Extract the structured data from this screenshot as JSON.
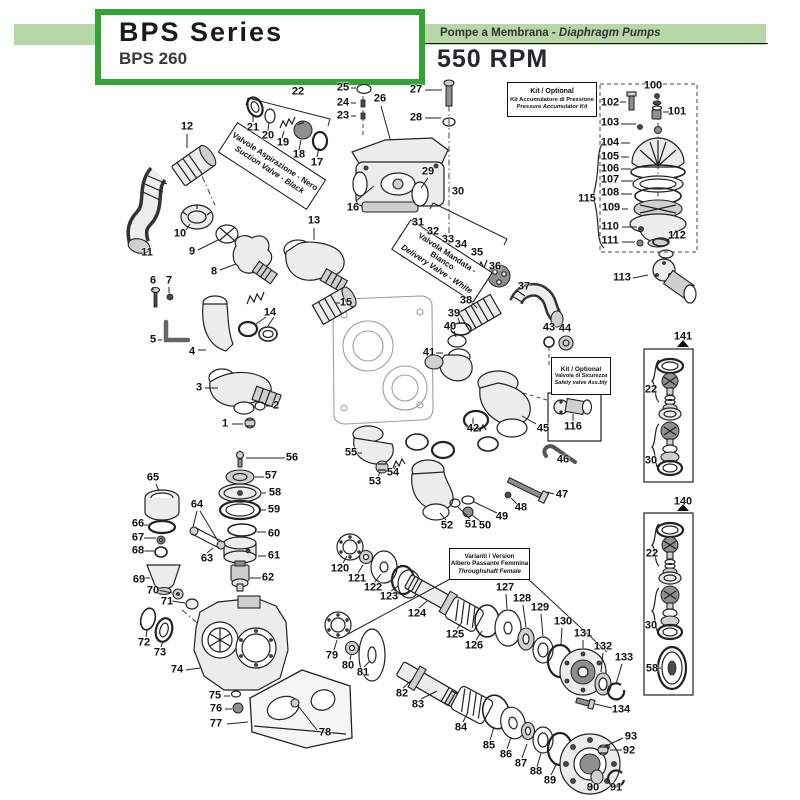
{
  "header": {
    "series_title": "BPS Series",
    "model": "BPS 260",
    "category_it": "Pompe a Membrana",
    "category_sep": " - ",
    "category_en": "Diaphragm Pumps",
    "rpm": "550 RPM",
    "accent_green": "#33A433",
    "band_green": "#B7D8A6"
  },
  "labels": {
    "suction_l1": "Valvole Aspirazione - Nero",
    "suction_l2": "Suction Valve - Black",
    "delivery_l1": "Valvola Mandata - Bianco",
    "delivery_l2": "Delivery Valve - White",
    "acc_l1": "Kit / Optional",
    "acc_l2": "Kit Accumulatore di Pressione",
    "acc_l3": "Pressure Accumulator Kit",
    "safety_l1": "Kit / Optional",
    "safety_l2": "Valvola di Sicurezza",
    "safety_l3": "Safety valve Ass.bly",
    "variant_l1": "Varianti / Version",
    "variant_l2": "Albero Passante Femmina",
    "variant_l3": "Throughshaft Female"
  },
  "callouts": [
    [
      "1",
      225,
      424
    ],
    [
      "2",
      276,
      406
    ],
    [
      "3",
      199,
      388
    ],
    [
      "4",
      192,
      352
    ],
    [
      "5",
      153,
      340
    ],
    [
      "6",
      153,
      281
    ],
    [
      "7",
      169,
      281
    ],
    [
      "8",
      214,
      272
    ],
    [
      "9",
      192,
      252
    ],
    [
      "10",
      180,
      234
    ],
    [
      "11",
      147,
      253
    ],
    [
      "12",
      187,
      127
    ],
    [
      "13",
      314,
      221
    ],
    [
      "14",
      270,
      313
    ],
    [
      "15",
      346,
      303
    ],
    [
      "16",
      353,
      208
    ],
    [
      "17",
      317,
      163
    ],
    [
      "18",
      299,
      155
    ],
    [
      "19",
      283,
      143
    ],
    [
      "20",
      268,
      136
    ],
    [
      "21",
      253,
      128
    ],
    [
      "22",
      298,
      92
    ],
    [
      "23",
      343,
      116
    ],
    [
      "24",
      343,
      103
    ],
    [
      "25",
      343,
      88
    ],
    [
      "26",
      380,
      99
    ],
    [
      "27",
      416,
      90
    ],
    [
      "28",
      416,
      118
    ],
    [
      "29",
      428,
      172
    ],
    [
      "30",
      458,
      192
    ],
    [
      "31",
      418,
      223
    ],
    [
      "32",
      433,
      232
    ],
    [
      "33",
      448,
      240
    ],
    [
      "34",
      461,
      245
    ],
    [
      "35",
      477,
      253
    ],
    [
      "36",
      495,
      267
    ],
    [
      "37",
      524,
      287
    ],
    [
      "38",
      466,
      301
    ],
    [
      "39",
      454,
      314
    ],
    [
      "40",
      450,
      327
    ],
    [
      "41",
      429,
      353
    ],
    [
      "42",
      473,
      429
    ],
    [
      "43",
      549,
      328
    ],
    [
      "44",
      565,
      329
    ],
    [
      "45",
      543,
      429
    ],
    [
      "46",
      563,
      460
    ],
    [
      "47",
      562,
      495
    ],
    [
      "48",
      521,
      508
    ],
    [
      "49",
      502,
      517
    ],
    [
      "50",
      485,
      526
    ],
    [
      "51",
      471,
      525
    ],
    [
      "52",
      447,
      526
    ],
    [
      "53",
      375,
      482
    ],
    [
      "54",
      393,
      473
    ],
    [
      "55",
      351,
      453
    ],
    [
      "56",
      292,
      458
    ],
    [
      "57",
      271,
      476
    ],
    [
      "58",
      275,
      493
    ],
    [
      "59",
      274,
      510
    ],
    [
      "60",
      274,
      534
    ],
    [
      "61",
      274,
      556
    ],
    [
      "62",
      268,
      578
    ],
    [
      "63",
      207,
      559
    ],
    [
      "64",
      197,
      505
    ],
    [
      "65",
      153,
      478
    ],
    [
      "66",
      138,
      524
    ],
    [
      "67",
      138,
      538
    ],
    [
      "68",
      138,
      551
    ],
    [
      "69",
      139,
      580
    ],
    [
      "70",
      153,
      591
    ],
    [
      "71",
      167,
      602
    ],
    [
      "72",
      144,
      643
    ],
    [
      "73",
      160,
      653
    ],
    [
      "74",
      177,
      670
    ],
    [
      "75",
      215,
      696
    ],
    [
      "76",
      216,
      709
    ],
    [
      "77",
      216,
      724
    ],
    [
      "78",
      325,
      733
    ],
    [
      "79",
      332,
      656
    ],
    [
      "80",
      348,
      666
    ],
    [
      "81",
      363,
      673
    ],
    [
      "82",
      402,
      694
    ],
    [
      "83",
      418,
      705
    ],
    [
      "84",
      461,
      728
    ],
    [
      "85",
      489,
      746
    ],
    [
      "86",
      506,
      755
    ],
    [
      "87",
      521,
      764
    ],
    [
      "88",
      536,
      772
    ],
    [
      "89",
      550,
      781
    ],
    [
      "90",
      593,
      788
    ],
    [
      "91",
      616,
      788
    ],
    [
      "92",
      629,
      751
    ],
    [
      "93",
      631,
      737
    ],
    [
      "100",
      653,
      86
    ],
    [
      "101",
      677,
      112
    ],
    [
      "102",
      610,
      103
    ],
    [
      "103",
      610,
      123
    ],
    [
      "104",
      610,
      143
    ],
    [
      "105",
      610,
      157
    ],
    [
      "106",
      610,
      169
    ],
    [
      "107",
      610,
      180
    ],
    [
      "108",
      610,
      193
    ],
    [
      "109",
      611,
      208
    ],
    [
      "110",
      610,
      227
    ],
    [
      "111",
      610,
      241
    ],
    [
      "112",
      677,
      236
    ],
    [
      "113",
      622,
      278
    ],
    [
      "115",
      587,
      199
    ],
    [
      "116",
      573,
      427
    ],
    [
      "120",
      340,
      569
    ],
    [
      "121",
      357,
      579
    ],
    [
      "122",
      373,
      588
    ],
    [
      "123",
      389,
      597
    ],
    [
      "124",
      417,
      614
    ],
    [
      "125",
      455,
      635
    ],
    [
      "126",
      474,
      646
    ],
    [
      "127",
      505,
      588
    ],
    [
      "128",
      522,
      599
    ],
    [
      "129",
      540,
      608
    ],
    [
      "130",
      563,
      622
    ],
    [
      "131",
      583,
      634
    ],
    [
      "132",
      603,
      647
    ],
    [
      "133",
      624,
      658
    ],
    [
      "134",
      621,
      710
    ],
    [
      "140",
      683,
      502
    ],
    [
      "141",
      683,
      337
    ],
    [
      "22",
      651,
      390
    ],
    [
      "30",
      651,
      461
    ],
    [
      "22",
      652,
      554
    ],
    [
      "30",
      651,
      626
    ],
    [
      "58",
      652,
      669
    ]
  ]
}
